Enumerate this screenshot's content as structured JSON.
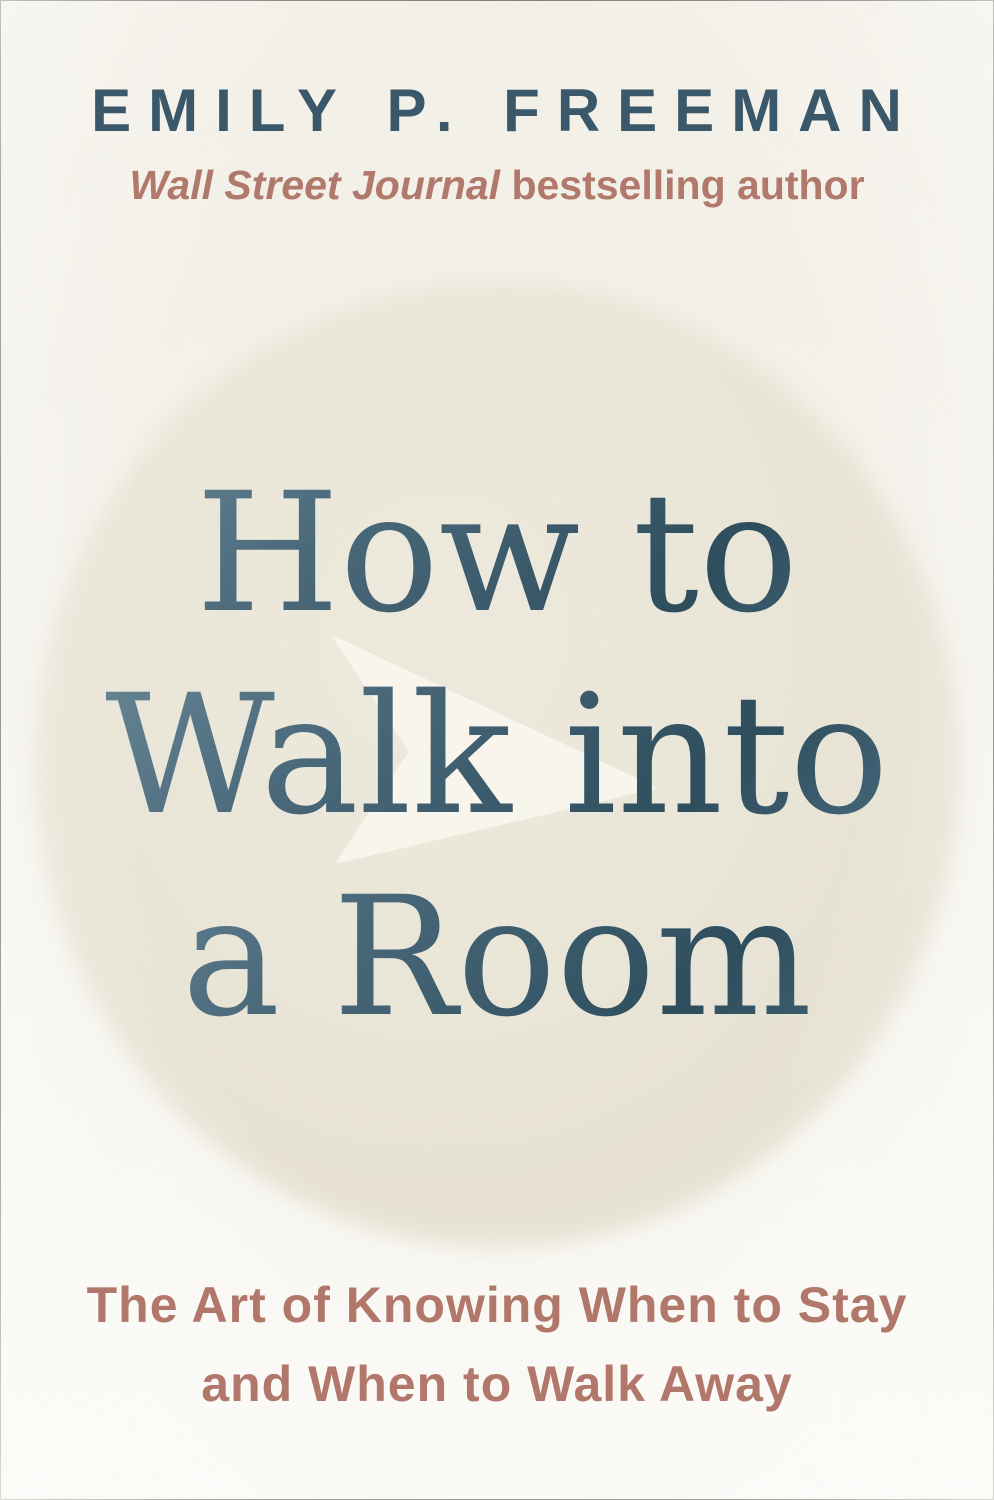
{
  "cover": {
    "author_name": "EMILY P. FREEMAN",
    "credential": {
      "publication": "Wall Street Journal",
      "suffix": " bestselling author"
    },
    "title": {
      "line1": "How to",
      "line2": "Walk into",
      "line3": "a Room",
      "full_title": "How to Walk into a Room"
    },
    "tagline": {
      "line1": "The Art of Knowing When to Stay",
      "line2": "and When to Walk Away"
    },
    "watermark": {
      "icon": "arrow-right-icon"
    },
    "colors": {
      "background_cream": "#f5f3ec",
      "circle_wash": "#e8e4d5",
      "arrow_watermark": "#fbf7ec",
      "title_foil_dark": "#2e4e5e",
      "title_foil_light": "#71909f",
      "author_teal": "#3a586a",
      "terracotta_accent": "#b1786a"
    }
  }
}
